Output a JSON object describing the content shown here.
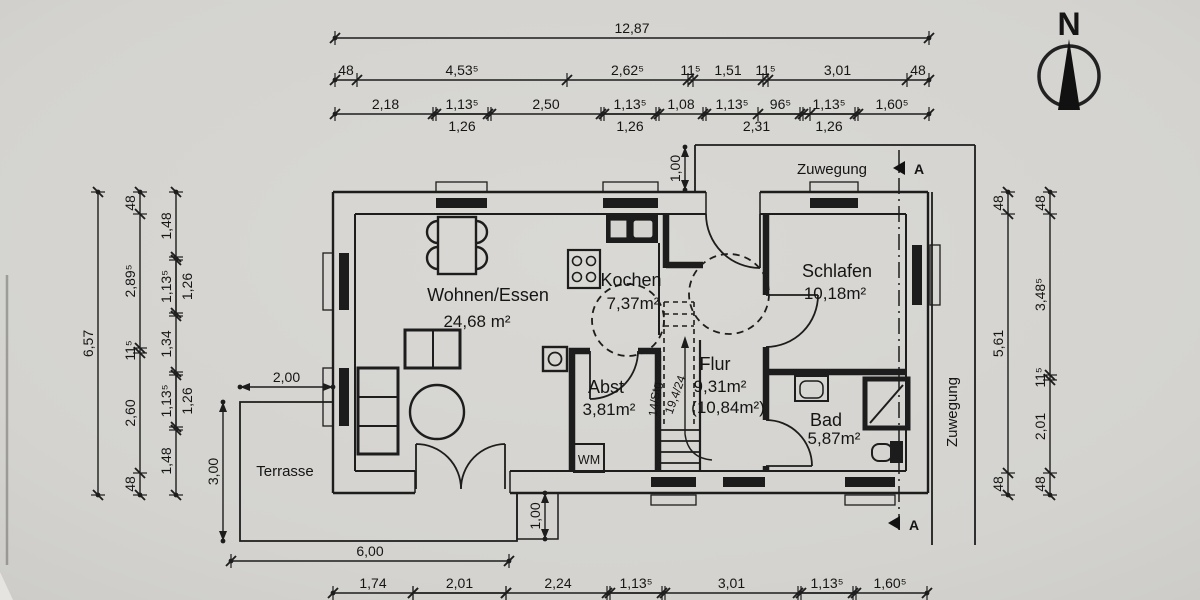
{
  "compass": {
    "label": "N"
  },
  "rooms": {
    "wohnen": {
      "name": "Wohnen/Essen",
      "area": "24,68 m²"
    },
    "kochen": {
      "name": "Kochen",
      "area": "7,37m²"
    },
    "abst": {
      "name": "Abst",
      "area": "3,81m²"
    },
    "flur": {
      "name": "Flur",
      "area": "9,31m²",
      "area2": "(10,84m²)"
    },
    "schlafen": {
      "name": "Schlafen",
      "area": "10,18m²"
    },
    "bad": {
      "name": "Bad",
      "area": "5,87m²"
    },
    "terrasse": {
      "name": "Terrasse"
    }
  },
  "annotations": {
    "zuwegung_top": "Zuwegung",
    "zuwegung_right": "Zuwegung",
    "wm": "WM",
    "stair_line1": "14/Stg.",
    "stair_line2": "19,4/24",
    "section_a_top": "A",
    "section_a_bottom": "A"
  },
  "dimensions": {
    "top_total": [
      "12,87"
    ],
    "top_row2": [
      "48",
      "4,53⁵",
      "2,62⁵",
      "11⁵",
      "1,51",
      "11⁵",
      "3,01",
      "48"
    ],
    "top_row3": [
      "2,18",
      "1,13⁵",
      "2,50",
      "1,13⁵",
      "1,08",
      "1,13⁵",
      "96⁵",
      "1,13⁵",
      "1,60⁵"
    ],
    "top_row3_sub": [
      "1,26",
      "1,26",
      "2,31",
      "1,26"
    ],
    "left_total": [
      "6,57"
    ],
    "left_row2": [
      "48",
      "2,89⁵",
      "11⁵",
      "2,60",
      "48"
    ],
    "left_row3": [
      "1,48",
      "1,13⁵",
      "1,34",
      "1,13⁵",
      "1,48"
    ],
    "left_row3_sub": [
      "1,26",
      "1,26"
    ],
    "right_row1": [
      "48",
      "5,61",
      "48"
    ],
    "right_row2": [
      "48",
      "3,48⁵",
      "11⁵",
      "2,01",
      "48"
    ],
    "bottom_terrace": [
      "6,00"
    ],
    "bottom_row": [
      "1,74",
      "2,01",
      "2,24",
      "1,13⁵",
      "3,01",
      "1,13⁵",
      "1,60⁵"
    ],
    "bottom_row_sub": [
      "2,31",
      "1,26",
      "1,26"
    ],
    "entry_width": [
      "1,00"
    ],
    "terrace_width": [
      "2,00"
    ],
    "terrace_depth": [
      "3,00"
    ],
    "step_depth": [
      "1,00"
    ]
  }
}
